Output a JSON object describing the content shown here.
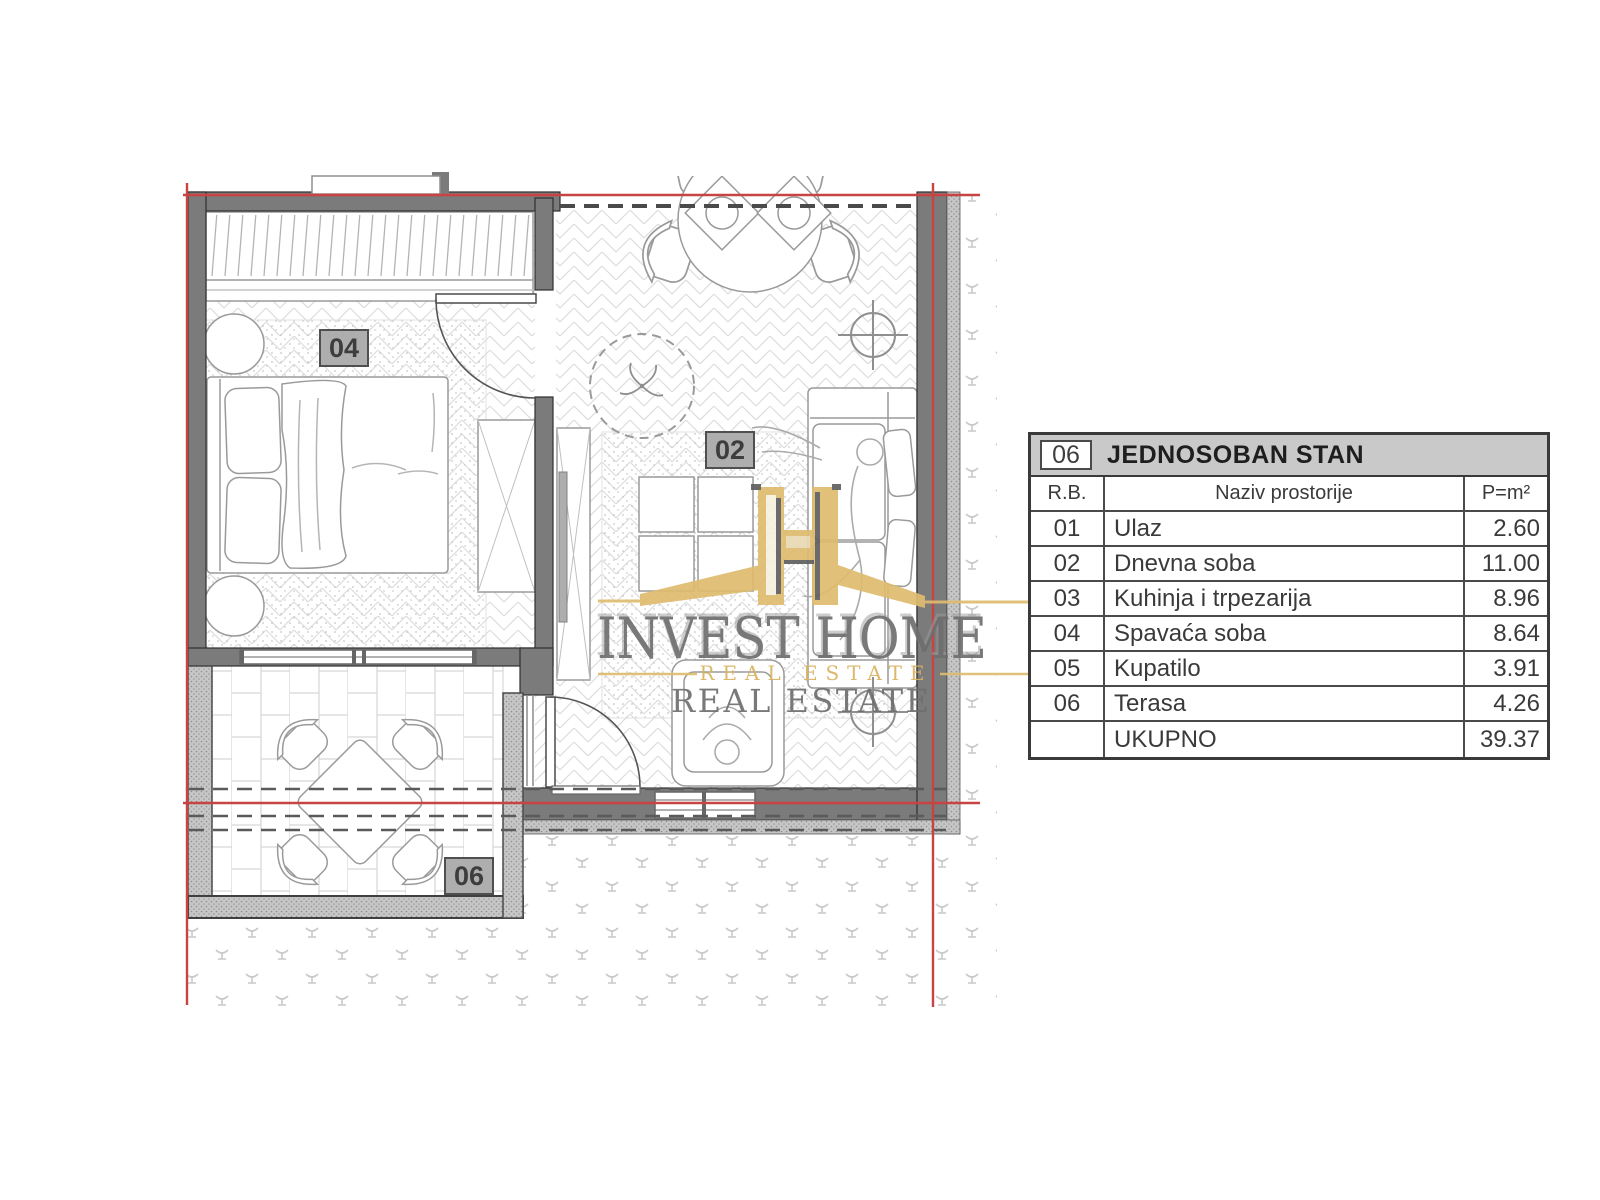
{
  "table": {
    "unit_badge": "06",
    "title": "JEDNOSOBAN STAN",
    "columns": {
      "index": "R.B.",
      "name": "Naziv prostorije",
      "area": "P=m²"
    },
    "rows": [
      {
        "index": "01",
        "name": "Ulaz",
        "area": "2.60"
      },
      {
        "index": "02",
        "name": "Dnevna soba",
        "area": "11.00"
      },
      {
        "index": "03",
        "name": "Kuhinja i trpezarija",
        "area": "8.96"
      },
      {
        "index": "04",
        "name": "Spavaća soba",
        "area": "8.64"
      },
      {
        "index": "05",
        "name": "Kupatilo",
        "area": "3.91"
      },
      {
        "index": "06",
        "name": "Terasa",
        "area": "4.26"
      }
    ],
    "total_row": {
      "index": "",
      "name": "UKUPNO",
      "area": "39.37"
    }
  },
  "floorplan": {
    "labels": [
      {
        "id": "04"
      },
      {
        "id": "02"
      },
      {
        "id": "06"
      }
    ]
  },
  "watermark": {
    "brand": "INVEST HOME",
    "tagline_gold": "REAL ESTATE",
    "tagline_gray": "REAL ESTATE"
  },
  "colors": {
    "axis_red": "#c84343",
    "wall_gray": "#7b7b7b",
    "header_gray": "#c9c9c9",
    "logo_gold": "#dfbc6f",
    "logo_gray": "#6e6e6e"
  }
}
